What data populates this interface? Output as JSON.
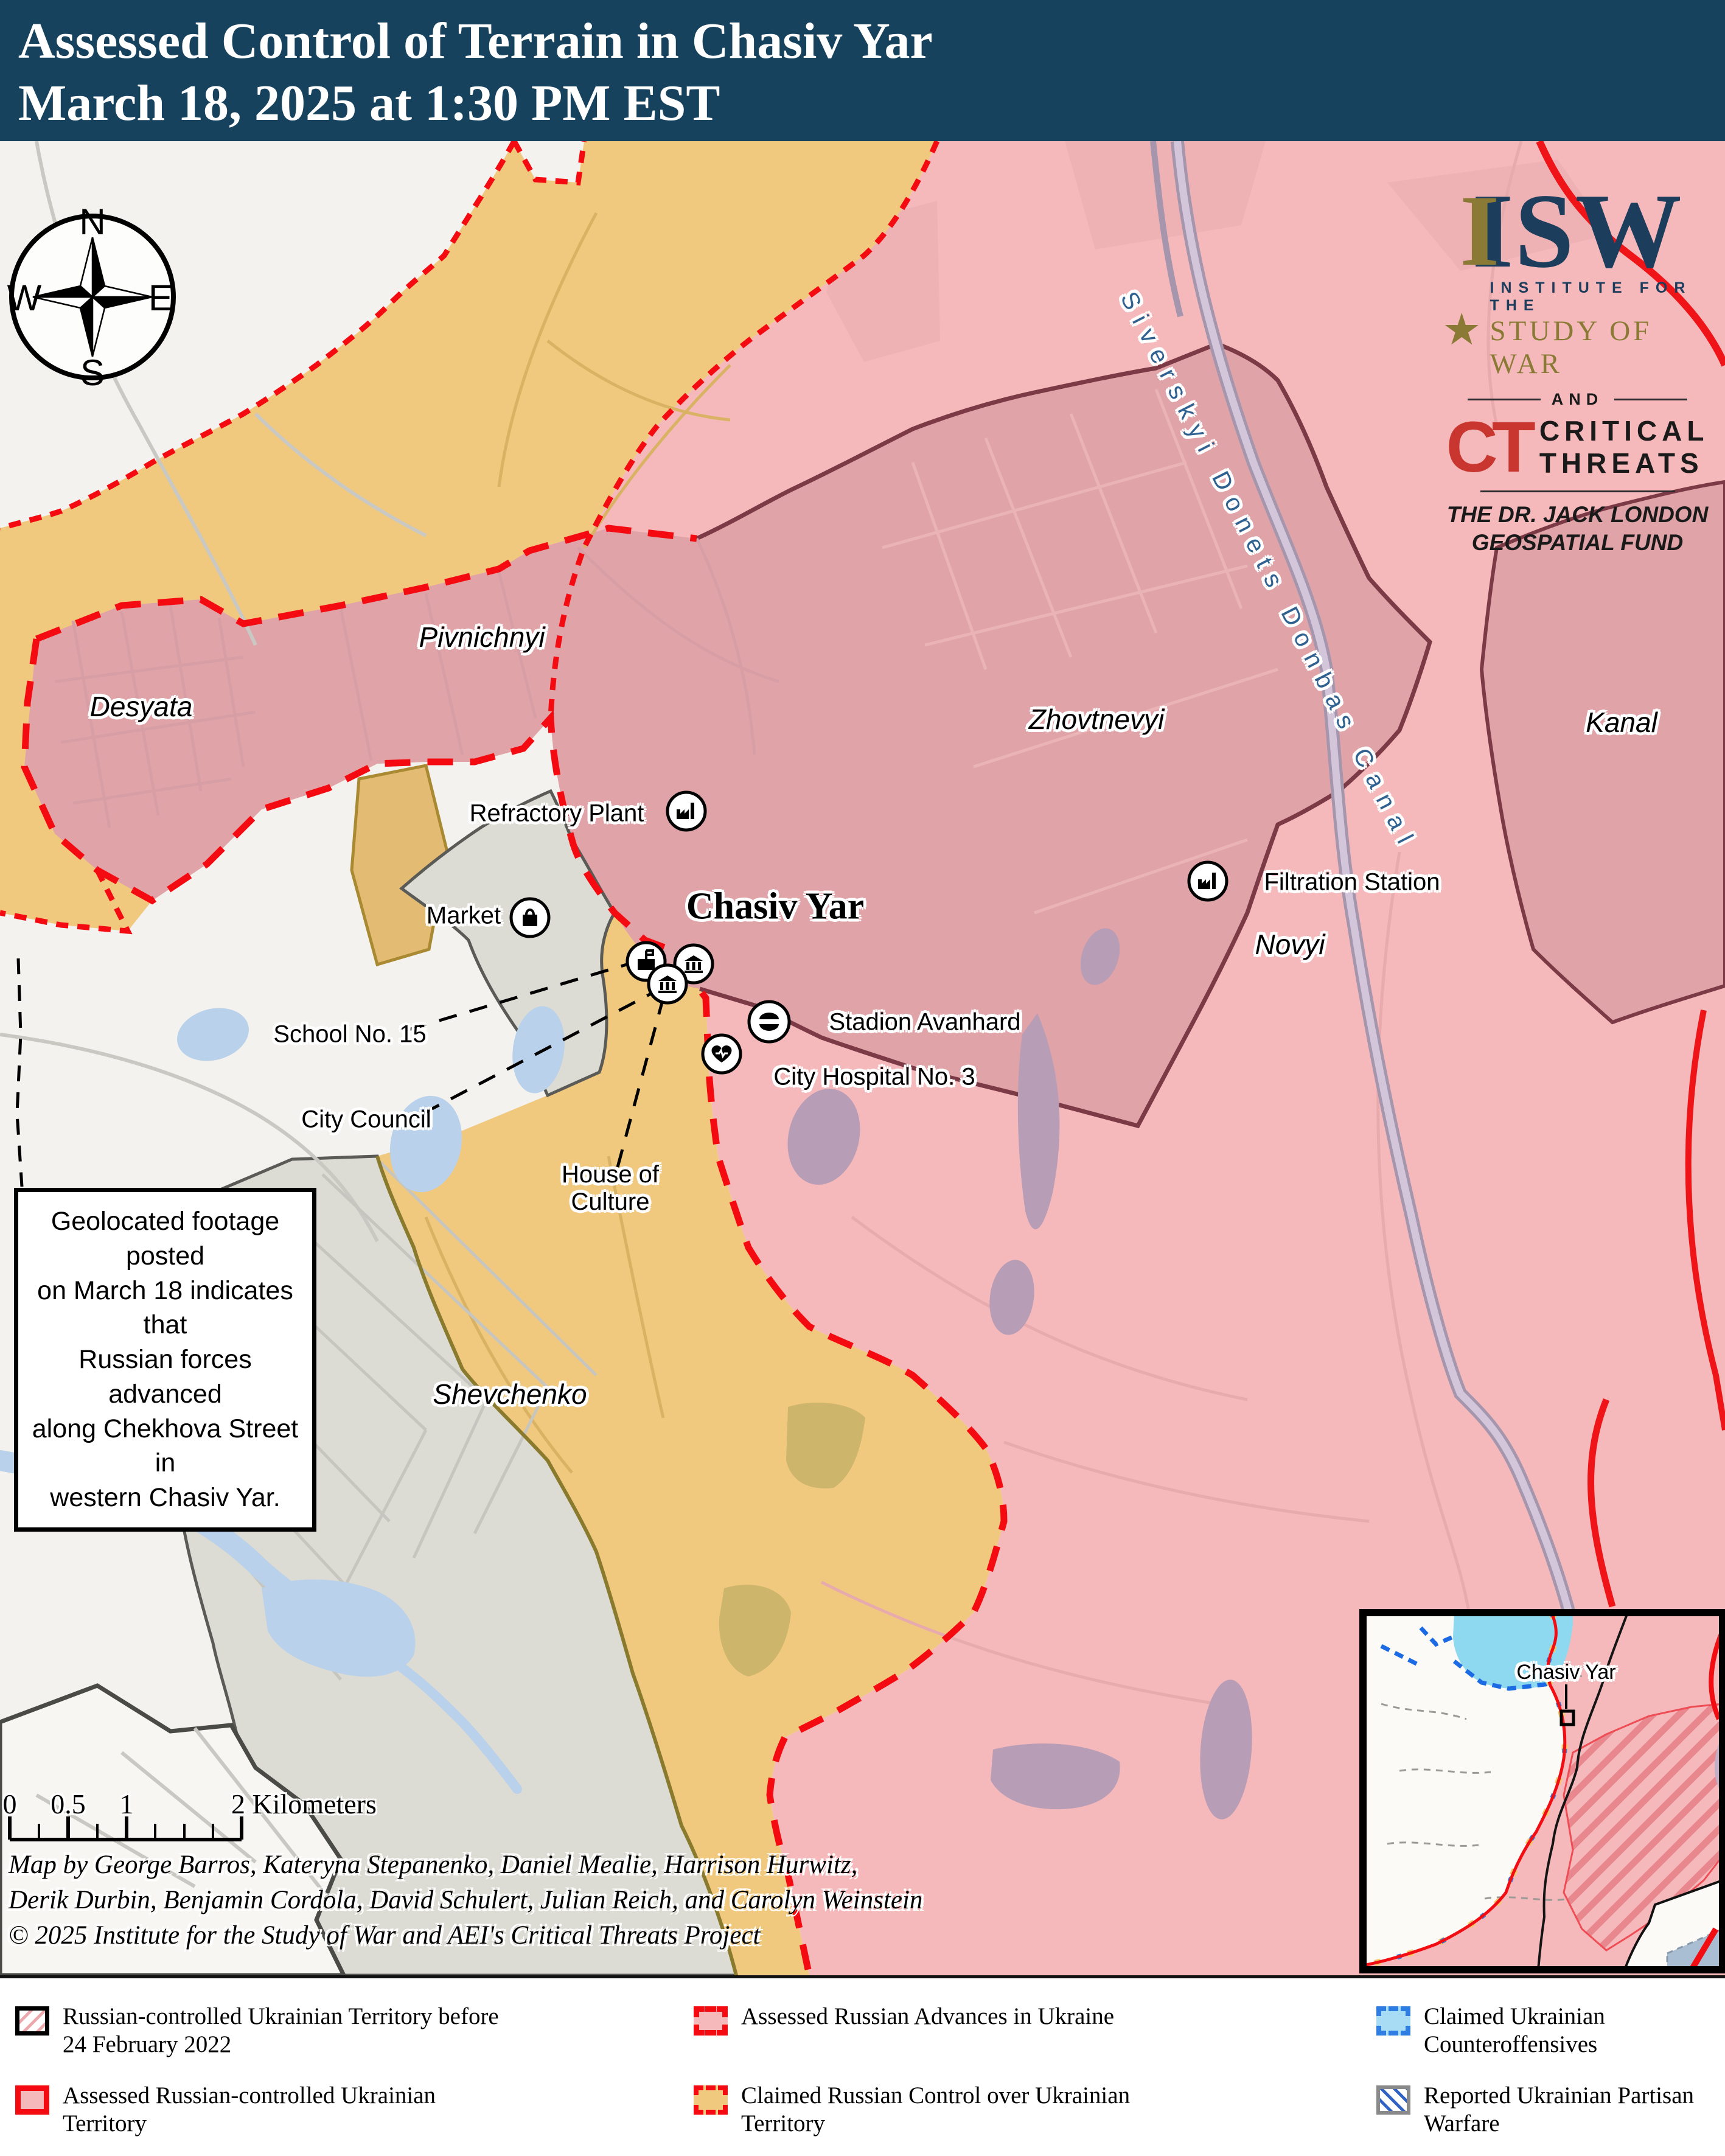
{
  "header": {
    "title_line1": "Assessed Control of Terrain in Chasiv Yar",
    "title_line2": "March 18, 2025 at 1:30 PM EST"
  },
  "logos": {
    "isw_acronym": "ISW",
    "isw_gold_i": "I",
    "star": "★",
    "isw_line1": "INSTITUTE FOR THE",
    "isw_line2": "STUDY OF WAR",
    "and": "AND",
    "ct_mark": "CT",
    "ct_line1": "CRITICAL",
    "ct_line2": "THREATS",
    "fund_line1": "THE DR. JACK LONDON",
    "fund_line2": "GEOSPATIAL FUND"
  },
  "compass": {
    "north": "N",
    "east": "E",
    "south": "S",
    "west": "W"
  },
  "map": {
    "city_label": "Chasiv Yar",
    "canal_label": "Siverskyi Donets Donbas Canal",
    "districts": {
      "desyata": "Desyata",
      "pivnichnyi": "Pivnichnyi",
      "zhovtnevyi": "Zhovtnevyi",
      "kanal": "Kanal",
      "novyi": "Novyi",
      "shevchenko": "Shevchenko"
    },
    "pois": {
      "refractory_plant": "Refractory Plant",
      "market": "Market",
      "school_15": "School No. 15",
      "city_council": "City Council",
      "house_of_culture": "House of\nCulture",
      "stadion": "Stadion Avanhard",
      "hospital": "City Hospital No. 3",
      "filtration_station": "Filtration Station"
    }
  },
  "annotation": {
    "text": "Geolocated footage posted\non March 18 indicates that\nRussian forces advanced\nalong Chekhova Street in\nwestern Chasiv Yar."
  },
  "scale_bar": {
    "tick_0": "0",
    "tick_05": "0.5",
    "tick_1": "1",
    "tick_2": "2 Kilometers"
  },
  "credits": {
    "line1": "Map by George Barros, Kateryna Stepanenko, Daniel Mealie, Harrison Hurwitz,",
    "line2": "Derik Durbin, Benjamin Cordola, David Schulert, Julian Reich, and Carolyn Weinstein",
    "line3": "© 2025 Institute for the Study of War and AEI's Critical Threats Project"
  },
  "inset": {
    "label": "Chasiv Yar"
  },
  "legend": {
    "items": [
      {
        "label": "Russian-controlled Ukrainian Territory before 24 February 2022"
      },
      {
        "label": "Assessed Russian-controlled Ukrainian Territory"
      },
      {
        "label": "Assessed Russian Advances in Ukraine"
      },
      {
        "label": "Claimed Russian Control over Ukrainian Territory"
      },
      {
        "label": "Claimed Ukrainian Counteroffensives"
      },
      {
        "label": "Reported Ukrainian Partisan Warfare"
      }
    ]
  },
  "colors": {
    "header_bg": "#16425d",
    "russian_controlled": "#f5b9bb",
    "russian_advance_fill": "#e0a3a8",
    "advance_border_maroon": "#7b3a45",
    "claimed_russian": "#f1c97e",
    "red_dash": "#f40b12",
    "counteroffensive_fill": "#a8dcf5",
    "counteroffensive_border": "#2f7de1",
    "urban_gray": "#dcdbd4",
    "water": "#b9d1ea",
    "canal": "#d4c6da"
  }
}
